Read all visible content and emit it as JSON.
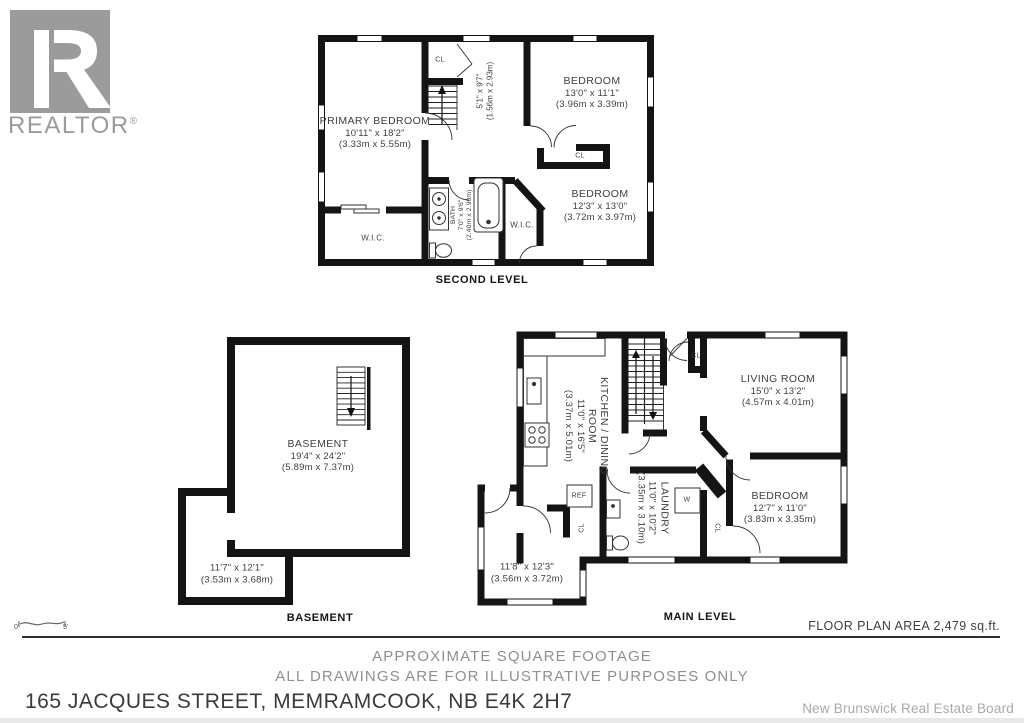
{
  "logo": {
    "brand": "REALTOR",
    "reg": "®"
  },
  "levels": {
    "second": {
      "title": "SECOND LEVEL",
      "primary": {
        "name": "PRIMARY BEDROOM",
        "imp": "10'11\" x 18'2\"",
        "met": "(3.33m x 5.55m)"
      },
      "bed1": {
        "name": "BEDROOM",
        "imp": "13'0\" x 11'1\"",
        "met": "(3.96m x 3.39m)"
      },
      "bed2": {
        "name": "BEDROOM",
        "imp": "12'3\" x 13'0\"",
        "met": "(3.72m x 3.97m)"
      },
      "hall": {
        "imp": "5'1\" x 9'7\"",
        "met": "(1.56m x 2.93m)"
      },
      "bath": {
        "name": "BATH",
        "imp": "7'0\" x 9'6\"",
        "met": "(2.40m x 2.90m)"
      },
      "wic1": "W.I.C.",
      "wic2": "W.I.C.",
      "cl1": "CL",
      "cl2": "CL"
    },
    "basement": {
      "title": "BASEMENT",
      "main": {
        "name": "BASEMENT",
        "imp": "19'4\" x 24'2\"",
        "met": "(5.89m x 7.37m)"
      },
      "room": {
        "imp": "11'7\" x 12'1\"",
        "met": "(3.53m x 3.68m)"
      }
    },
    "main": {
      "title": "MAIN LEVEL",
      "kitchen": {
        "name1": "KITCHEN / DINING",
        "name2": "ROOM",
        "imp": "11'0\" x 16'5\"",
        "met": "(3.37m x 5.01m)"
      },
      "living": {
        "name": "LIVING ROOM",
        "imp": "15'0\" x 13'2\"",
        "met": "(4.57m x 4.01m)"
      },
      "laundry": {
        "name": "LAUNDRY",
        "imp": "11'0\" x 10'2\"",
        "met": "(3.35m x 3.10m)"
      },
      "bedroom": {
        "name": "BEDROOM",
        "imp": "12'7\" x 11'0\"",
        "met": "(3.83m x 3.35m)"
      },
      "room": {
        "imp": "11'8\" x 12'3\"",
        "met": "(3.56m x 3.72m)"
      },
      "ref": "REF",
      "washer": "W",
      "cl_entry": "CL",
      "cl_small": "CL",
      "cl_bedroom": "CL"
    }
  },
  "scale": {
    "zero": "0'",
    "five": "5'"
  },
  "footer": {
    "area": "FLOOR PLAN AREA 2,479 sq.ft.",
    "note1": "APPROXIMATE SQUARE FOOTAGE",
    "note2": "ALL DRAWINGS ARE FOR ILLUSTRATIVE PURPOSES ONLY",
    "address": "165 JACQUES STREET, MEMRAMCOOK, NB E4K 2H7",
    "board": "New Brunswick Real Estate Board"
  },
  "colors": {
    "wall": "#141414",
    "label": "#3f3f3f",
    "muted": "#8f8f8f",
    "logo_gray": "#9b9b9b"
  }
}
